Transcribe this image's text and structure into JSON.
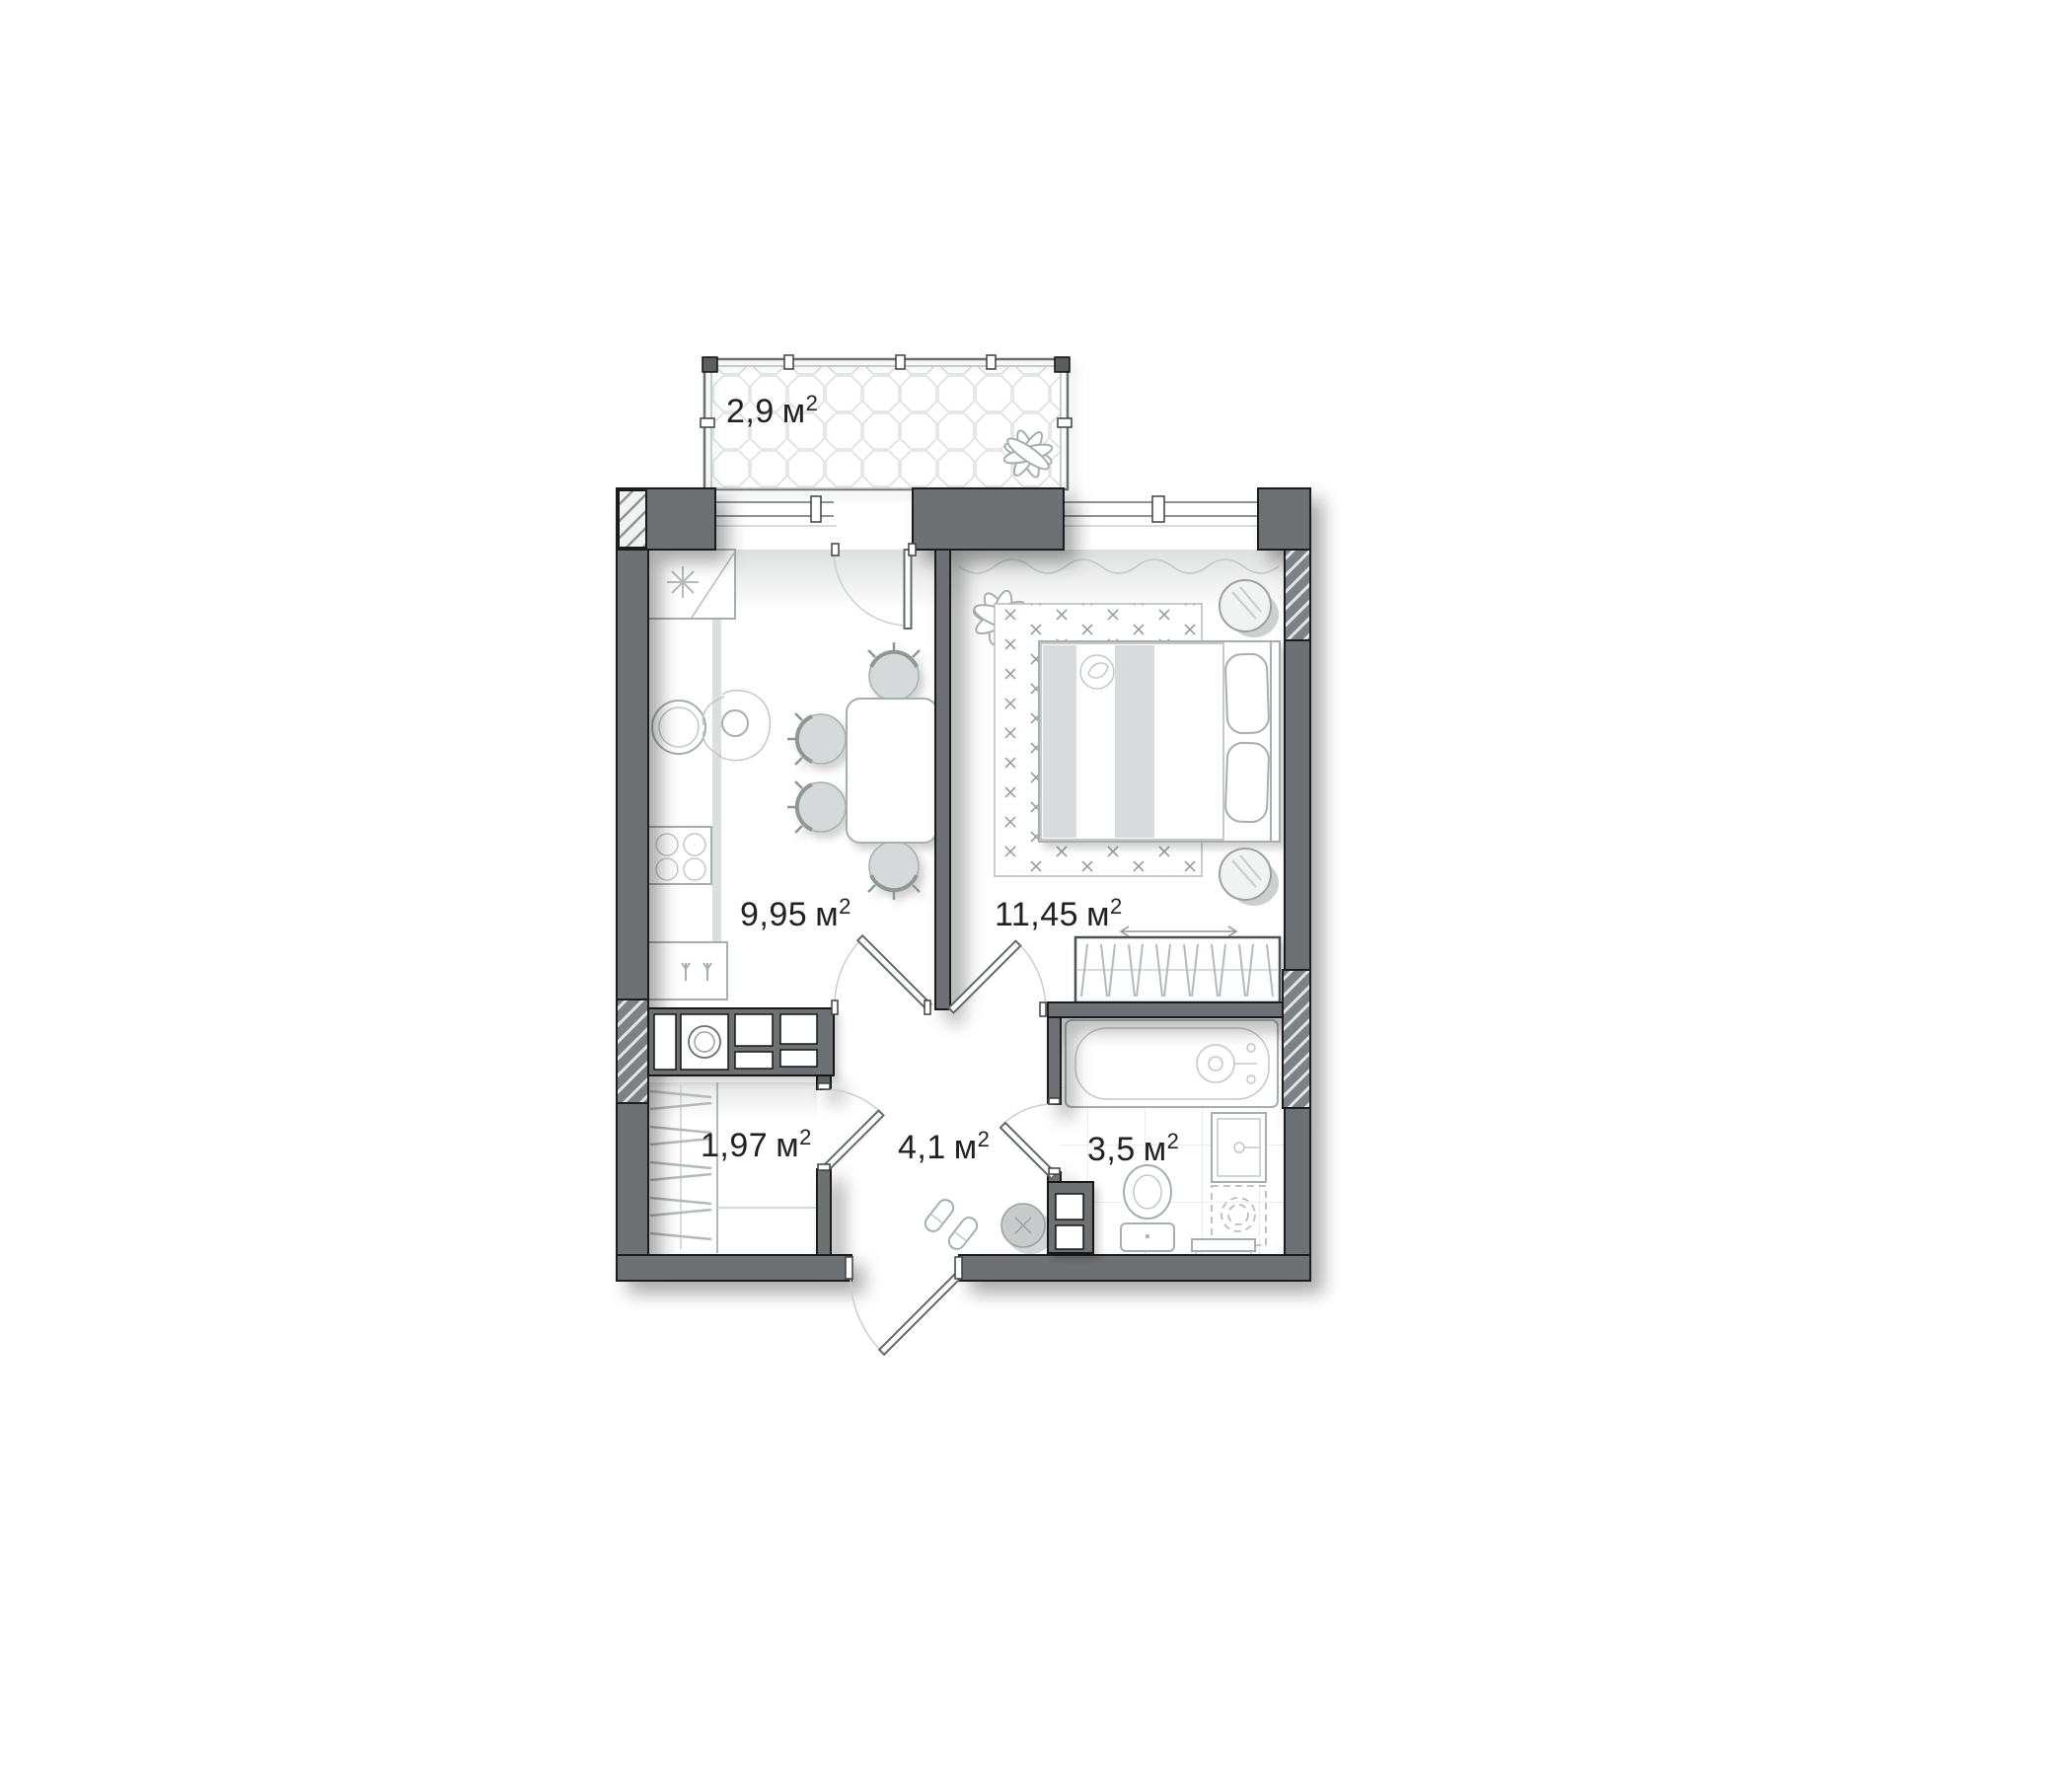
{
  "rooms": {
    "balcony": {
      "name": "balcony",
      "area": "2,9",
      "unit": "м",
      "sup": "2"
    },
    "kitchen": {
      "name": "kitchen",
      "area": "9,95",
      "unit": "м",
      "sup": "2"
    },
    "bedroom": {
      "name": "bedroom",
      "area": "11,45",
      "unit": "м",
      "sup": "2"
    },
    "storage": {
      "name": "storage",
      "area": "1,97",
      "unit": "м",
      "sup": "2"
    },
    "hallway": {
      "name": "hallway",
      "area": "4,1",
      "unit": "м",
      "sup": "2"
    },
    "bathroom": {
      "name": "bathroom",
      "area": "3,5",
      "unit": "м",
      "sup": "2"
    }
  },
  "colors": {
    "wall": "#6e7173",
    "wall_outline": "#1b1b1b",
    "furniture_line": "#a7aeae",
    "light_fill": "#d6d9d9",
    "label_text": "#212121",
    "background": "#ffffff"
  }
}
